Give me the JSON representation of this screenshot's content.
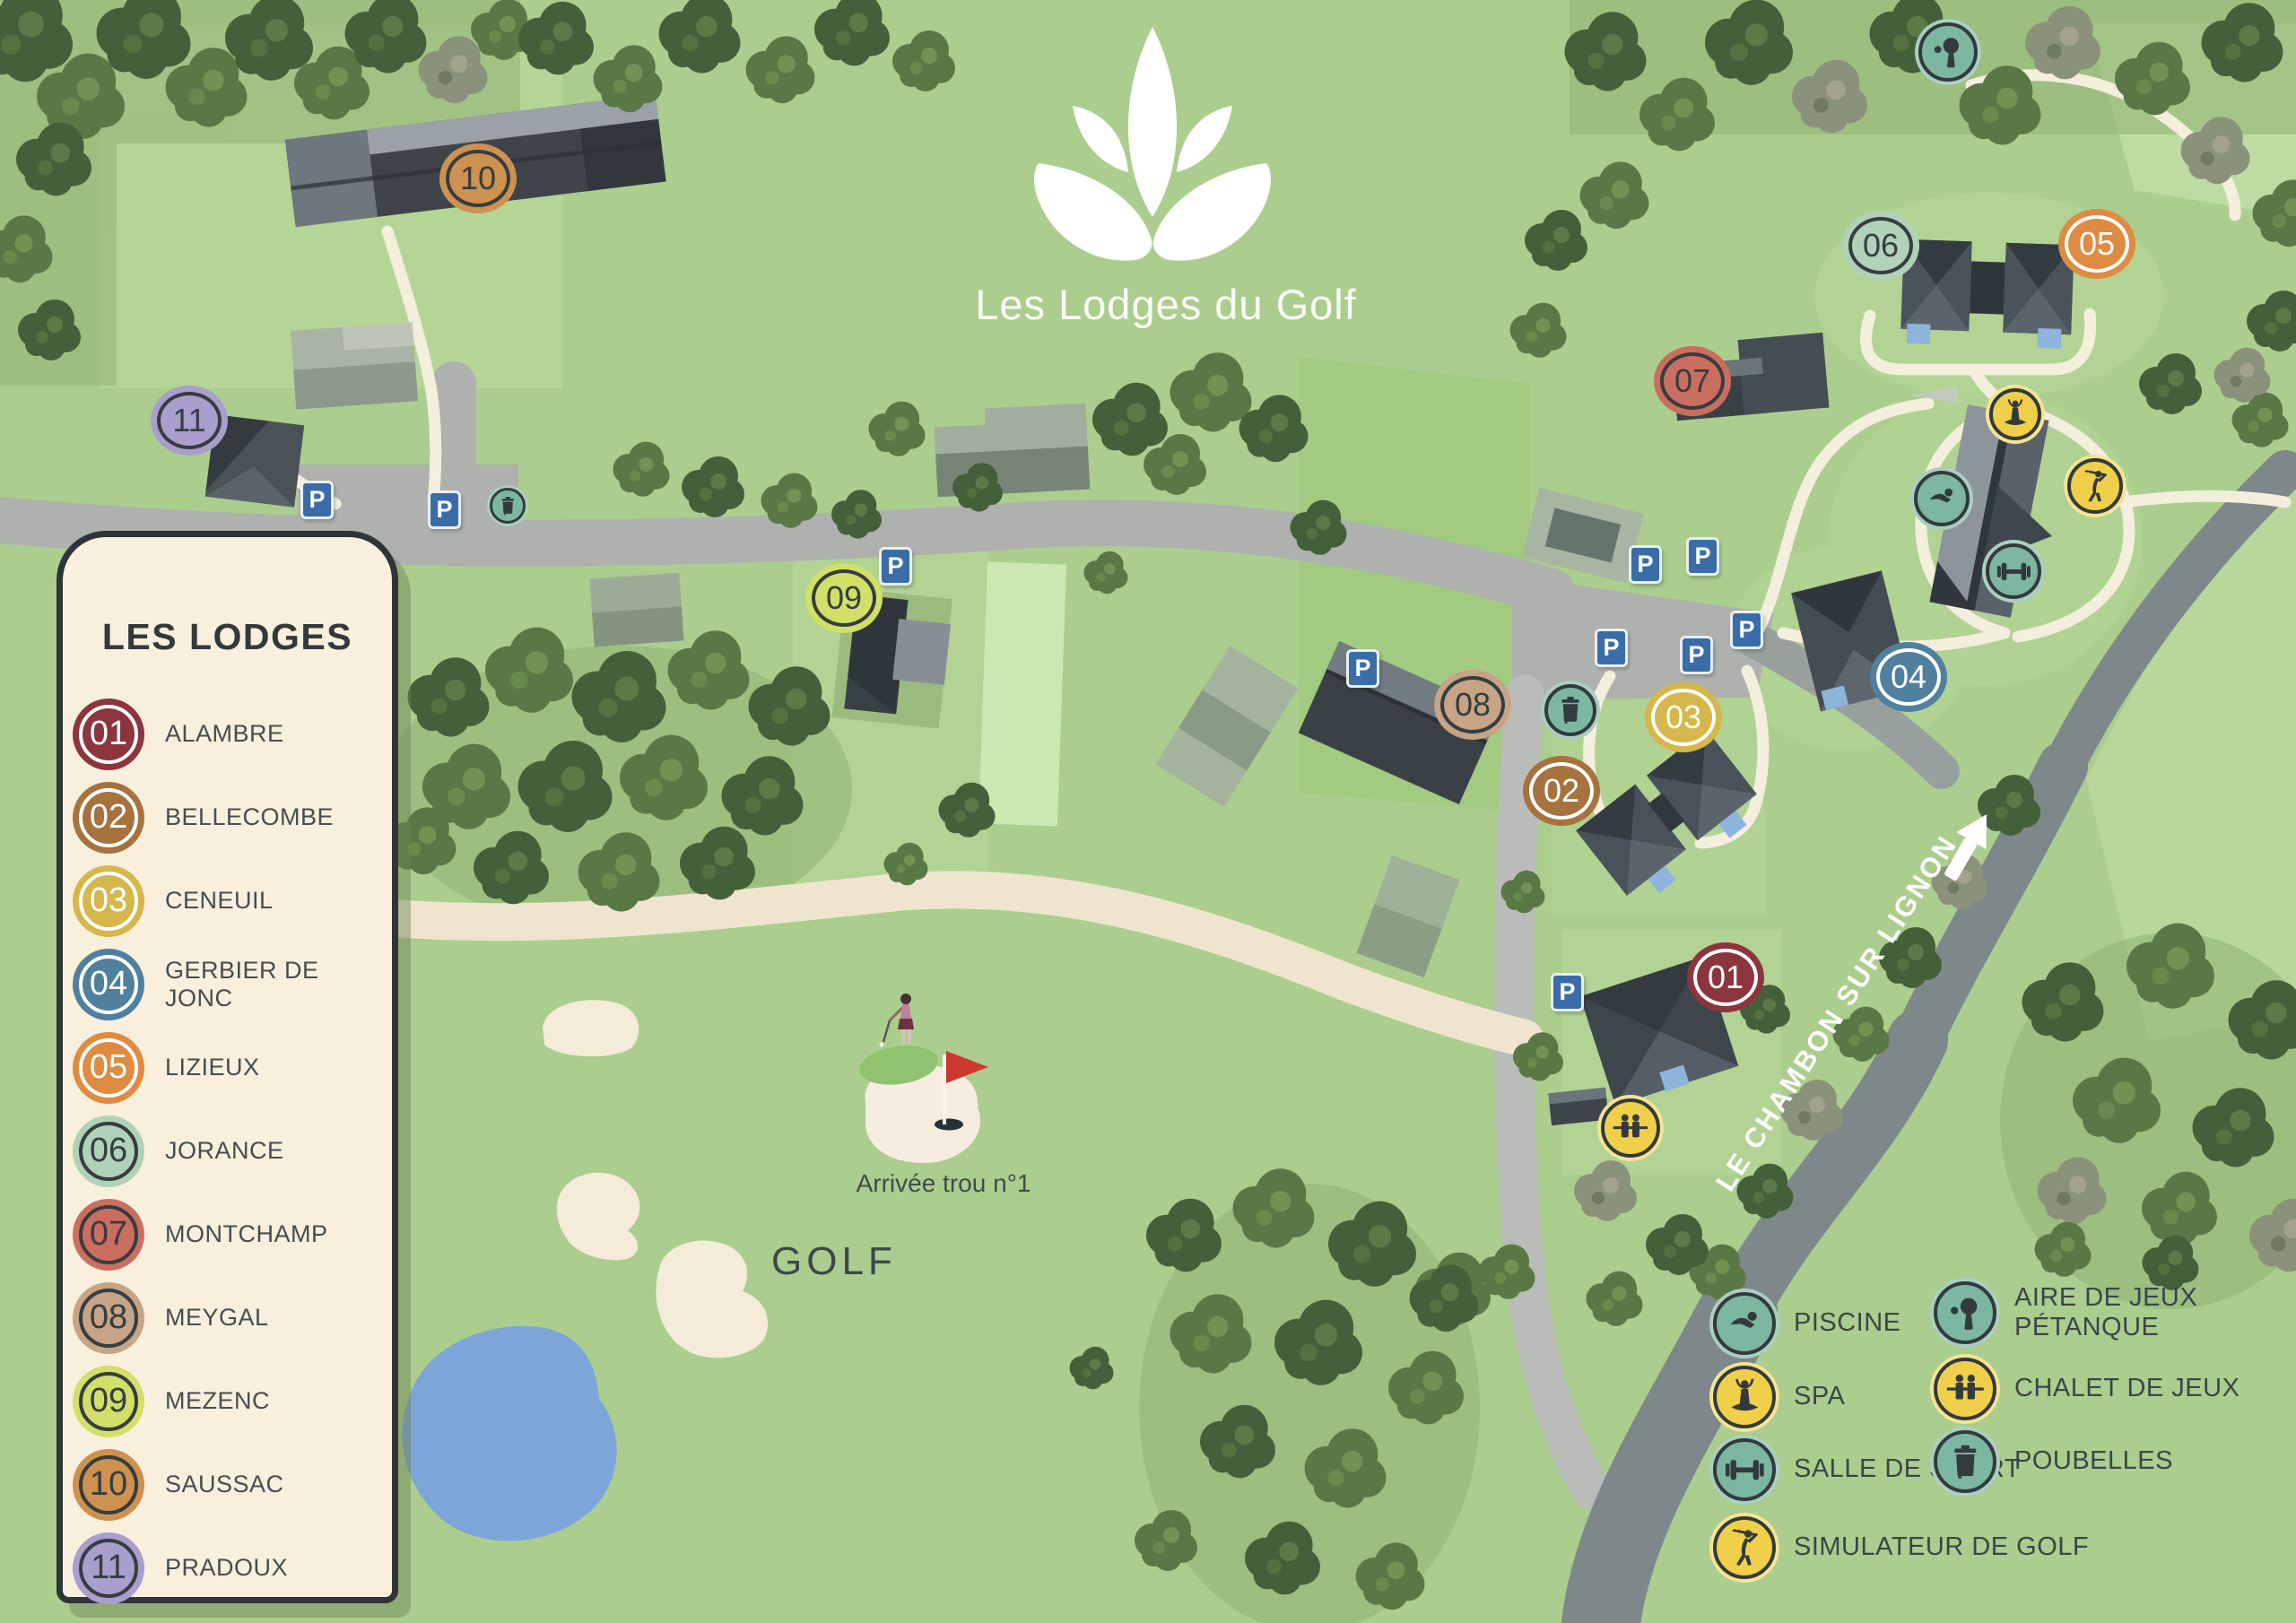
{
  "header": {
    "title": "Les Lodges du Golf"
  },
  "lodge_legend": {
    "title": "LES LODGES",
    "items": [
      {
        "num": "01",
        "name": "ALAMBRE",
        "color": "#8c353d",
        "ring": "#ffffff"
      },
      {
        "num": "02",
        "name": "BELLECOMBE",
        "color": "#a6723e",
        "ring": "#ffffff"
      },
      {
        "num": "03",
        "name": "CENEUIL",
        "color": "#d5b74b",
        "ring": "#ffffff"
      },
      {
        "num": "04",
        "name": "GERBIER DE JONC",
        "color": "#50809e",
        "ring": "#ffffff"
      },
      {
        "num": "05",
        "name": "LIZIEUX",
        "color": "#df8b41",
        "ring": "#ffffff"
      },
      {
        "num": "06",
        "name": "JORANCE",
        "color": "#afd2b8",
        "ring": "#363d40"
      },
      {
        "num": "07",
        "name": "MONTCHAMP",
        "color": "#ca6e60",
        "ring": "#363d40"
      },
      {
        "num": "08",
        "name": "MEYGAL",
        "color": "#c6a485",
        "ring": "#363d40"
      },
      {
        "num": "09",
        "name": "MEZENC",
        "color": "#d2df68",
        "ring": "#363d40"
      },
      {
        "num": "10",
        "name": "SAUSSAC",
        "color": "#cd9150",
        "ring": "#363d40"
      },
      {
        "num": "11",
        "name": "PRADOUX",
        "color": "#aa9ecd",
        "ring": "#363d40"
      }
    ]
  },
  "amenity_legend": {
    "items": [
      {
        "icon": "piscine-icon",
        "label": "PISCINE",
        "fill": "teal"
      },
      {
        "icon": "spa-icon",
        "label": "SPA",
        "fill": "yellow"
      },
      {
        "icon": "salle-de-sport-icon",
        "label": "SALLE DE SPORT",
        "fill": "teal"
      },
      {
        "icon": "simulateur-golf-icon",
        "label": "SIMULATEUR DE GOLF",
        "fill": "yellow"
      },
      {
        "icon": "aire-de-jeux-petanque-icon",
        "label": "AIRE DE JEUX\nPÉTANQUE",
        "fill": "teal"
      },
      {
        "icon": "chalet-de-jeux-icon",
        "label": "CHALET DE JEUX",
        "fill": "yellow"
      },
      {
        "icon": "poubelles-icon",
        "label": "POUBELLES",
        "fill": "teal"
      }
    ]
  },
  "map_labels": {
    "road": "LE CHAMBON SUR LIGNON",
    "golf": "GOLF",
    "hole_arrival": "Arrivée trou n°1",
    "parking": "P"
  },
  "colors": {
    "teal": "#7cb7a2",
    "teal_halo": "#aacfc2",
    "yellow": "#f0cf4a",
    "yellow_halo": "#f5e493",
    "glyph": "#333a3e",
    "parking_blue": "#3a6da7",
    "base_green": "#abce8e",
    "road_gray": "#aeb1ad",
    "main_road_gray": "#7e888a",
    "path_cream": "#f4eedd",
    "panel_cream": "#f8efdc",
    "pond_blue": "#7ea5d8",
    "bunker_sand": "#f5ebd9"
  }
}
